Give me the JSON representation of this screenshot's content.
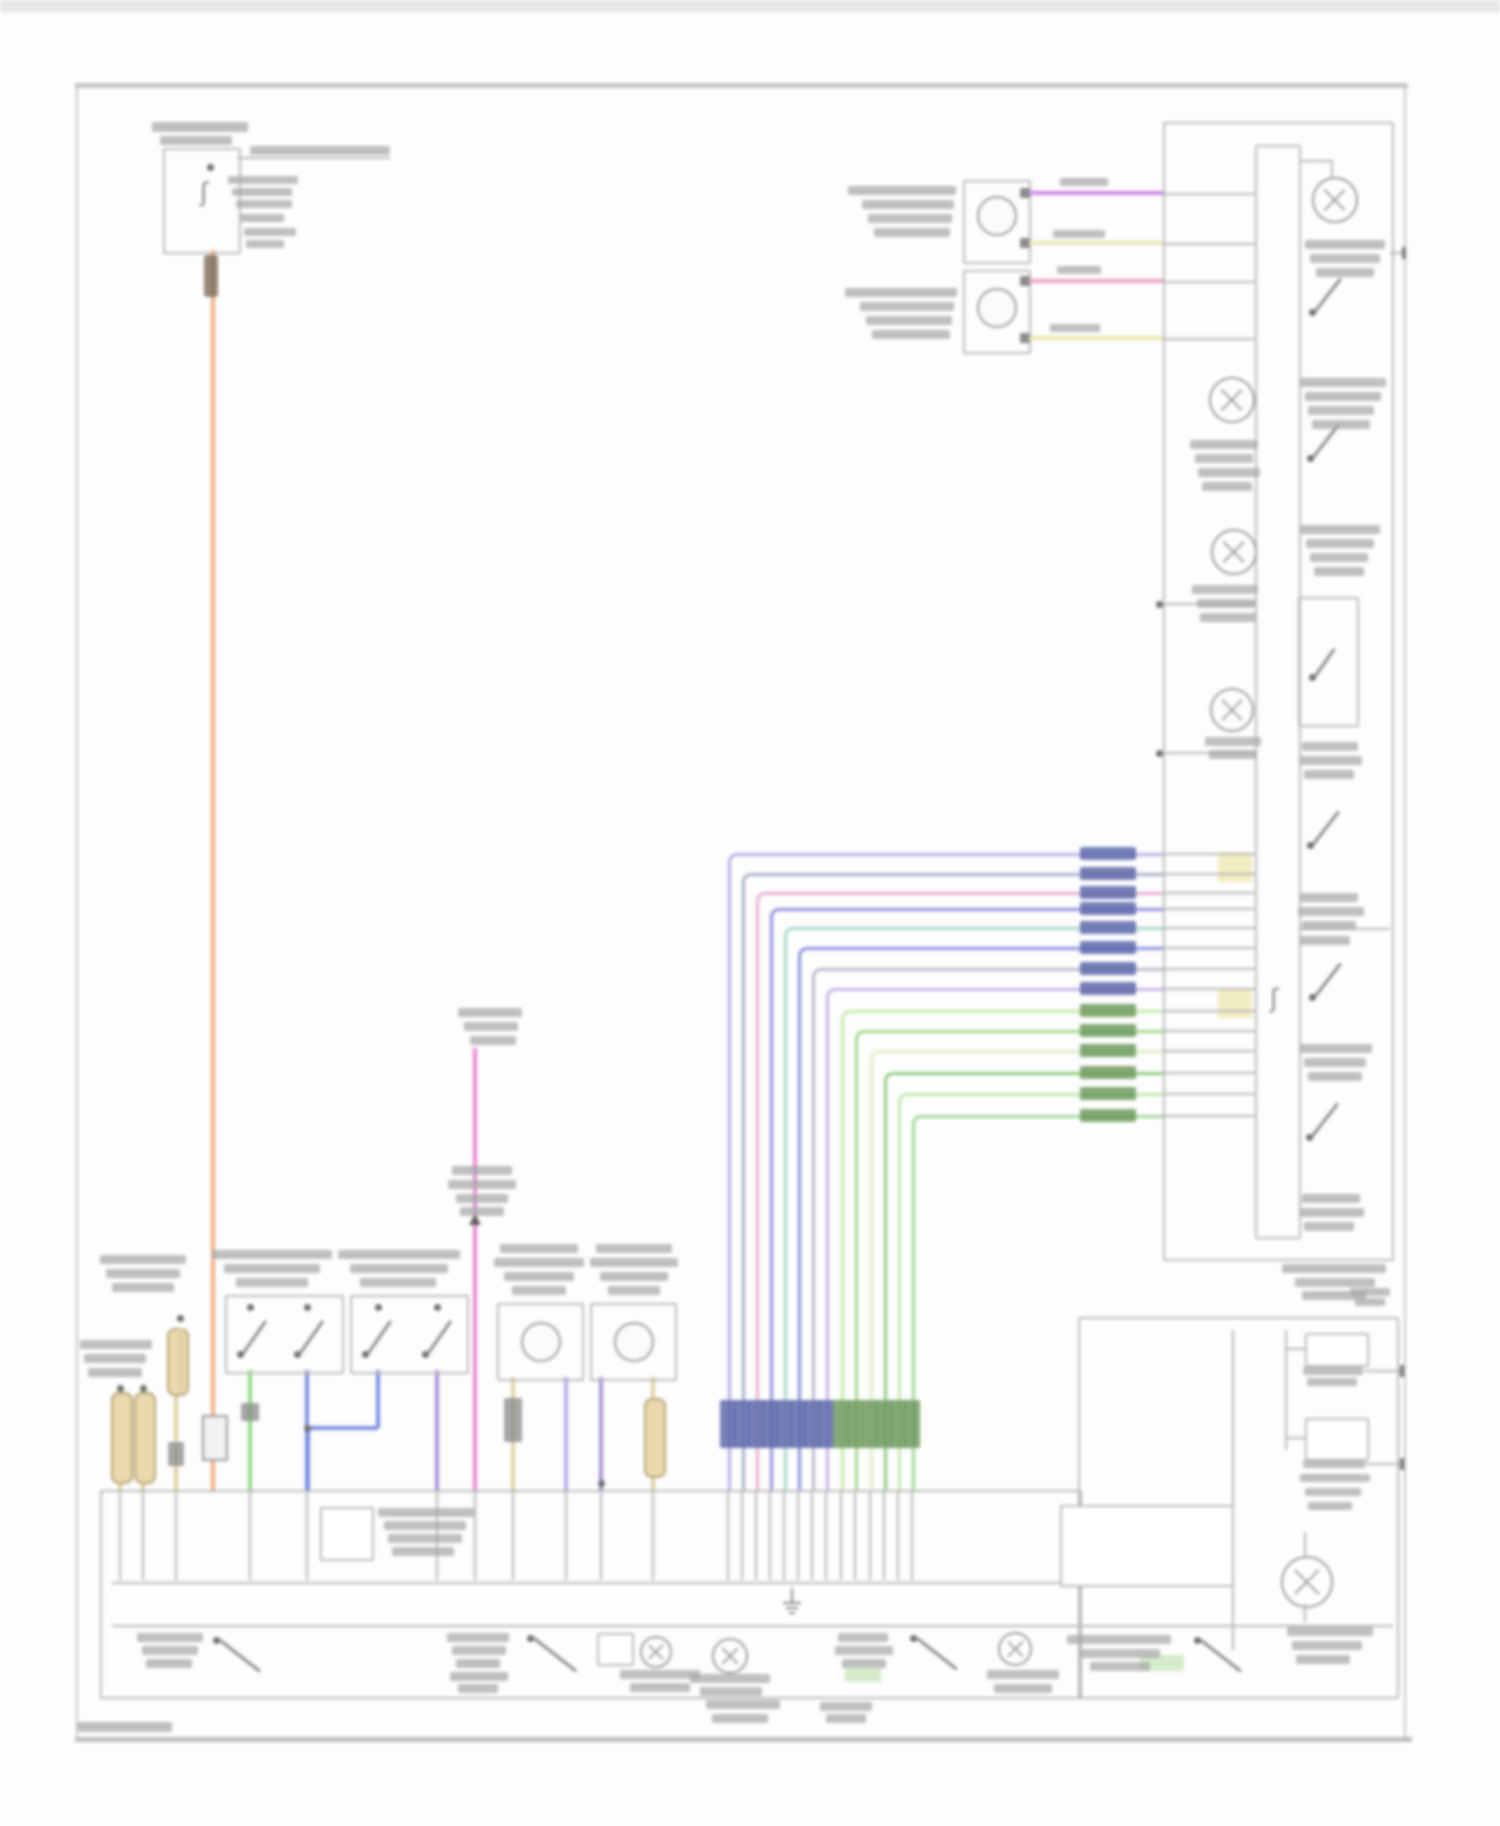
{
  "meta": {
    "kind": "automotive wiring diagram (blurred scan, all labels illegible)",
    "page_width": 1500,
    "page_height": 1826
  },
  "palette": {
    "line_gray": "#b6b6b6",
    "dark_mark": "#6e6e6e",
    "smudge_text": "#a6a6a6",
    "orange": "#f0ae85",
    "purple": "#cc88e8",
    "pale_yellow": "#ece5ad",
    "pink": "#f0a2c4",
    "magenta": "#ee86d6",
    "green": "#8edc84",
    "blue": "#7a8ce0",
    "lavender": "#b3aae6",
    "violet": "#a98fd8",
    "khaki": "#ddd0a0",
    "label_blue_block": "#5e68aa",
    "label_green_block": "#6f9a5f",
    "pale_yellow_block": "#efeab8",
    "pale_green_block": "#cfe8c2"
  },
  "frame": {
    "top_strip": [
      0,
      0,
      1500,
      12
    ],
    "top_border": [
      75,
      83,
      1333,
      5
    ],
    "left_border_x": 76,
    "right_border_x": 1404,
    "bottom_border": [
      75,
      1737,
      1337,
      5
    ],
    "border_top_y": 83,
    "border_bottom_y": 1742
  },
  "fuse_circuit": {
    "box": [
      163,
      148,
      74,
      102
    ],
    "stub_line_y": 157,
    "stub_x2": 390,
    "fuse_dot": [
      210,
      167
    ],
    "orange_riser": {
      "x": 211,
      "y1": 250,
      "y2": 1490
    },
    "connector_block": [
      202,
      1415,
      22,
      42
    ]
  },
  "top_motors": {
    "boxes": [
      [
        963,
        180,
        64,
        80
      ],
      [
        963,
        270,
        64,
        80
      ]
    ],
    "circles": [
      [
        977,
        196,
        36
      ],
      [
        977,
        288,
        36
      ]
    ],
    "pin_blocks": [
      [
        1020,
        188
      ],
      [
        1020,
        238
      ],
      [
        1020,
        276
      ],
      [
        1020,
        333
      ]
    ],
    "wires": [
      {
        "y": 193,
        "x1": 1029,
        "x2": 1163,
        "color": "purple"
      },
      {
        "y": 243,
        "x1": 1029,
        "x2": 1163,
        "color": "pale_yellow"
      },
      {
        "y": 281,
        "x1": 1029,
        "x2": 1163,
        "color": "pink"
      },
      {
        "y": 338,
        "x1": 1029,
        "x2": 1163,
        "color": "pale_yellow"
      }
    ]
  },
  "right_box": {
    "outer": [
      1163,
      122,
      227,
      1135
    ],
    "inner": [
      1255,
      145,
      42,
      1090
    ],
    "top_gray_lines_y": [
      193,
      243,
      281,
      338
    ],
    "tap_lines": [
      {
        "y": 603,
        "dot": true
      },
      {
        "y": 752,
        "dot": true
      }
    ],
    "tr_lamp": {
      "cx": 1333,
      "cy": 198,
      "r": 21,
      "elbow_h": [
        1299,
        160,
        34
      ],
      "elbow_v": [
        1331,
        160,
        20
      ]
    },
    "left_lamps": [
      [
        1230,
        398,
        21
      ],
      [
        1232,
        550,
        21
      ],
      [
        1230,
        708,
        20
      ]
    ],
    "switches": [
      {
        "x": 1312,
        "y": 312,
        "len": 42,
        "angle": -52
      },
      {
        "x": 1310,
        "y": 458,
        "len": 42,
        "angle": -52
      },
      {
        "x": 1310,
        "y": 845,
        "len": 42,
        "angle": -52
      },
      {
        "x": 1312,
        "y": 997,
        "len": 42,
        "angle": -52
      },
      {
        "x": 1309,
        "y": 1137,
        "len": 42,
        "angle": -52
      }
    ],
    "switch_box": [
      1298,
      597,
      57,
      126
    ],
    "inner_line": [
      1300,
      928,
      90
    ],
    "right_stub": {
      "y": 252,
      "x1": 1390,
      "x2": 1404
    },
    "squiggle": [
      1270,
      986
    ],
    "pale_blocks": [
      [
        1218,
        852,
        34,
        30
      ],
      [
        1218,
        990,
        34,
        28
      ]
    ]
  },
  "bundle": {
    "x_end": 1163,
    "bus_y": 1490,
    "label_x": 1080,
    "label_w": 56,
    "bottom_label_y": 1400,
    "bottom_label_h": 48,
    "wires": [
      {
        "y": 853,
        "cx": 728,
        "color": "#b7aee8",
        "group": "blue"
      },
      {
        "y": 873,
        "cx": 742,
        "color": "#a8b0c8",
        "group": "blue"
      },
      {
        "y": 892,
        "cx": 756,
        "color": "#e8b0d0",
        "group": "blue"
      },
      {
        "y": 908,
        "cx": 770,
        "color": "#9090dc",
        "group": "blue"
      },
      {
        "y": 927,
        "cx": 784,
        "color": "#a8d8cc",
        "group": "blue"
      },
      {
        "y": 947,
        "cx": 798,
        "color": "#8890e0",
        "group": "blue"
      },
      {
        "y": 968,
        "cx": 812,
        "color": "#b8b8cc",
        "group": "blue"
      },
      {
        "y": 988,
        "cx": 826,
        "color": "#c8b4e4",
        "group": "blue"
      },
      {
        "y": 1010,
        "cx": 841,
        "color": "#c8e8a8",
        "group": "green"
      },
      {
        "y": 1030,
        "cx": 855,
        "color": "#a8d890",
        "group": "green"
      },
      {
        "y": 1050,
        "cx": 870,
        "color": "#e0eec8",
        "group": "green"
      },
      {
        "y": 1072,
        "cx": 884,
        "color": "#90cc80",
        "group": "green"
      },
      {
        "y": 1093,
        "cx": 898,
        "color": "#c4e8b0",
        "group": "green"
      },
      {
        "y": 1115,
        "cx": 912,
        "color": "#a0d898",
        "group": "green"
      }
    ]
  },
  "bottom_area": {
    "module_box": [
      100,
      1490,
      978,
      205
    ],
    "right_box": [
      1078,
      1317,
      317,
      378
    ],
    "inner_line_1": [
      112,
      1582,
      948
    ],
    "inner_line_2": [
      112,
      1625,
      1281
    ],
    "inner_small_box": [
      320,
      1507,
      50,
      50
    ],
    "sub_box_right": [
      1060,
      1505,
      170,
      78
    ],
    "ground_symbol": [
      783,
      1588
    ],
    "bus_y": 1490,
    "gray_stub_y2": 1580
  },
  "bottom_drops": [
    {
      "x": 120,
      "color": "khaki",
      "y1": 1388,
      "capsule": [
        111,
        1392,
        88
      ],
      "dot": [
        120,
        1388
      ]
    },
    {
      "x": 143,
      "color": "khaki",
      "y1": 1388,
      "capsule": [
        134,
        1392,
        88
      ],
      "dot": [
        143,
        1388
      ]
    },
    {
      "x": 176,
      "color": "khaki",
      "y1": 1392,
      "dot": [
        176,
        1392
      ],
      "block": [
        168,
        1442,
        16,
        24
      ]
    },
    {
      "x": 250,
      "color": "green",
      "y1": 1370,
      "block": [
        241,
        1403,
        18,
        18
      ]
    },
    {
      "x": 307,
      "color": "blue",
      "y1": 1370
    },
    {
      "x": 437,
      "color": "violet",
      "y1": 1370
    },
    {
      "x": 475,
      "color": "magenta",
      "y1": 1048
    },
    {
      "x": 513,
      "color": "khaki",
      "y1": 1377,
      "block": [
        504,
        1398,
        18,
        44
      ]
    },
    {
      "x": 566,
      "color": "lavender",
      "y1": 1377
    },
    {
      "x": 601,
      "color": "violet",
      "y1": 1377,
      "dot": [
        601,
        1483
      ]
    },
    {
      "x": 653,
      "color": "khaki",
      "y1": 1377,
      "capsule": [
        644,
        1398,
        76
      ]
    }
  ],
  "blue_link": {
    "jx": 307,
    "jy": 1428,
    "x2": 378,
    "up_y": 1370
  },
  "left_components": {
    "switch_boxes": [
      [
        225,
        1295,
        115,
        75
      ],
      [
        350,
        1295,
        115,
        75
      ]
    ],
    "switch_pins": [
      [
        250,
        1307
      ],
      [
        307,
        1307
      ],
      [
        378,
        1307
      ],
      [
        437,
        1307
      ]
    ],
    "box_switches": [
      {
        "x": 240,
        "y": 1354,
        "len": 40,
        "angle": -55
      },
      {
        "x": 297,
        "y": 1354,
        "len": 40,
        "angle": -55
      },
      {
        "x": 365,
        "y": 1354,
        "len": 40,
        "angle": -55
      },
      {
        "x": 425,
        "y": 1354,
        "len": 40,
        "angle": -55
      }
    ],
    "motor_boxes": [
      [
        497,
        1303,
        83,
        74
      ],
      [
        590,
        1303,
        83,
        74
      ]
    ],
    "motor_circles": [
      [
        521,
        1322,
        36
      ],
      [
        614,
        1322,
        36
      ]
    ],
    "upper_capsule": [
      167,
      1328,
      64
    ],
    "upper_dot": [
      180,
      1318
    ],
    "pink_arrow": [
      469,
      1214
    ]
  },
  "bottom_row": {
    "switches": [
      {
        "x": 216,
        "y": 1640,
        "len": 52,
        "angle": 38
      },
      {
        "x": 530,
        "y": 1638,
        "len": 55,
        "angle": 38
      },
      {
        "x": 913,
        "y": 1638,
        "len": 52,
        "angle": 38
      },
      {
        "x": 1197,
        "y": 1640,
        "len": 52,
        "angle": 38
      }
    ],
    "small_box": [
      597,
      1633,
      33,
      29
    ],
    "lamps": [
      [
        640,
        1636,
        28
      ],
      [
        712,
        1638,
        32
      ],
      [
        998,
        1632,
        30
      ]
    ],
    "big_lamp": [
      1281,
      1556,
      48
    ],
    "big_lamp_line": [
      [
        1304,
        1532,
        26
      ],
      [
        1604,
        0,
        0
      ]
    ],
    "green_blocks": [
      [
        845,
        1668,
        36,
        14
      ],
      [
        1140,
        1655,
        44,
        16
      ]
    ]
  },
  "right_bottom_parts": {
    "inner_v1": [
      1232,
      1330,
      320
    ],
    "inner_v2": [
      1285,
      1330,
      120
    ],
    "boxA": [
      1305,
      1333,
      60,
      30
    ],
    "boxB": [
      1305,
      1418,
      60,
      39
    ],
    "stubA": {
      "y": 1370,
      "x1": 1365,
      "x2": 1402
    },
    "stubB": {
      "y": 1463,
      "x1": 1365,
      "x2": 1402
    },
    "linkA_y": 1348,
    "linkB_y": 1437
  },
  "unreadable_labels": [
    [
      152,
      122,
      96,
      10
    ],
    [
      160,
      136,
      72,
      9
    ],
    [
      250,
      146,
      140,
      9
    ],
    [
      228,
      176,
      70,
      8
    ],
    [
      232,
      188,
      60,
      8
    ],
    [
      236,
      200,
      56,
      8
    ],
    [
      240,
      214,
      44,
      8
    ],
    [
      244,
      228,
      52,
      8
    ],
    [
      246,
      240,
      38,
      8
    ],
    [
      848,
      186,
      108,
      9
    ],
    [
      862,
      200,
      92,
      9
    ],
    [
      868,
      214,
      84,
      9
    ],
    [
      874,
      228,
      76,
      9
    ],
    [
      845,
      288,
      112,
      9
    ],
    [
      860,
      302,
      94,
      9
    ],
    [
      866,
      316,
      86,
      9
    ],
    [
      872,
      330,
      78,
      9
    ],
    [
      1060,
      178,
      48,
      8
    ],
    [
      1053,
      230,
      52,
      8
    ],
    [
      1057,
      266,
      44,
      8
    ],
    [
      1050,
      324,
      50,
      8
    ],
    [
      1305,
      240,
      80,
      9
    ],
    [
      1310,
      254,
      70,
      9
    ],
    [
      1316,
      268,
      58,
      9
    ],
    [
      1300,
      378,
      86,
      9
    ],
    [
      1305,
      392,
      76,
      9
    ],
    [
      1308,
      406,
      66,
      9
    ],
    [
      1312,
      420,
      58,
      9
    ],
    [
      1190,
      440,
      68,
      9
    ],
    [
      1195,
      454,
      58,
      9
    ],
    [
      1198,
      468,
      62,
      9
    ],
    [
      1202,
      482,
      50,
      9
    ],
    [
      1300,
      525,
      80,
      9
    ],
    [
      1306,
      539,
      68,
      9
    ],
    [
      1310,
      553,
      58,
      9
    ],
    [
      1314,
      567,
      50,
      9
    ],
    [
      1192,
      585,
      66,
      9
    ],
    [
      1197,
      599,
      58,
      9
    ],
    [
      1200,
      613,
      56,
      9
    ],
    [
      1205,
      737,
      56,
      9
    ],
    [
      1209,
      750,
      48,
      9
    ],
    [
      1302,
      742,
      56,
      9
    ],
    [
      1300,
      756,
      62,
      9
    ],
    [
      1304,
      770,
      50,
      9
    ],
    [
      1300,
      893,
      58,
      9
    ],
    [
      1298,
      907,
      66,
      9
    ],
    [
      1302,
      921,
      54,
      9
    ],
    [
      1300,
      936,
      50,
      9
    ],
    [
      1300,
      1044,
      72,
      9
    ],
    [
      1304,
      1058,
      62,
      9
    ],
    [
      1308,
      1072,
      54,
      9
    ],
    [
      1302,
      1194,
      58,
      9
    ],
    [
      1300,
      1208,
      64,
      9
    ],
    [
      1304,
      1222,
      50,
      9
    ],
    [
      1282,
      1264,
      104,
      9
    ],
    [
      1295,
      1278,
      80,
      9
    ],
    [
      1302,
      1291,
      64,
      9
    ],
    [
      100,
      1255,
      86,
      9
    ],
    [
      106,
      1269,
      74,
      9
    ],
    [
      112,
      1283,
      62,
      9
    ],
    [
      80,
      1340,
      72,
      9
    ],
    [
      84,
      1354,
      62,
      9
    ],
    [
      88,
      1368,
      54,
      9
    ],
    [
      212,
      1250,
      120,
      9
    ],
    [
      224,
      1264,
      96,
      9
    ],
    [
      236,
      1278,
      72,
      9
    ],
    [
      338,
      1250,
      122,
      9
    ],
    [
      350,
      1264,
      98,
      9
    ],
    [
      360,
      1278,
      76,
      9
    ],
    [
      458,
      1008,
      64,
      9
    ],
    [
      464,
      1022,
      54,
      9
    ],
    [
      470,
      1036,
      46,
      9
    ],
    [
      452,
      1166,
      60,
      9
    ],
    [
      448,
      1180,
      68,
      9
    ],
    [
      456,
      1194,
      52,
      9
    ],
    [
      460,
      1207,
      44,
      9
    ],
    [
      500,
      1244,
      78,
      9
    ],
    [
      494,
      1258,
      90,
      9
    ],
    [
      504,
      1272,
      70,
      9
    ],
    [
      512,
      1286,
      54,
      9
    ],
    [
      596,
      1244,
      76,
      9
    ],
    [
      590,
      1258,
      88,
      9
    ],
    [
      600,
      1272,
      68,
      9
    ],
    [
      608,
      1286,
      52,
      9
    ],
    [
      378,
      1508,
      96,
      9
    ],
    [
      384,
      1521,
      82,
      9
    ],
    [
      388,
      1534,
      74,
      9
    ],
    [
      392,
      1547,
      62,
      9
    ],
    [
      137,
      1633,
      66,
      9
    ],
    [
      142,
      1646,
      56,
      9
    ],
    [
      146,
      1659,
      46,
      9
    ],
    [
      447,
      1633,
      62,
      9
    ],
    [
      452,
      1646,
      54,
      9
    ],
    [
      456,
      1659,
      44,
      9
    ],
    [
      450,
      1672,
      58,
      9
    ],
    [
      458,
      1684,
      40,
      9
    ],
    [
      620,
      1670,
      80,
      9
    ],
    [
      630,
      1683,
      60,
      9
    ],
    [
      690,
      1674,
      80,
      9
    ],
    [
      700,
      1687,
      62,
      9
    ],
    [
      706,
      1700,
      74,
      9
    ],
    [
      712,
      1714,
      56,
      9
    ],
    [
      838,
      1633,
      50,
      9
    ],
    [
      835,
      1646,
      58,
      9
    ],
    [
      842,
      1659,
      44,
      9
    ],
    [
      987,
      1670,
      72,
      9
    ],
    [
      994,
      1684,
      58,
      9
    ],
    [
      820,
      1702,
      52,
      9
    ],
    [
      826,
      1714,
      40,
      9
    ],
    [
      1067,
      1635,
      104,
      9
    ],
    [
      1080,
      1649,
      80,
      9
    ],
    [
      1090,
      1662,
      60,
      9
    ],
    [
      1303,
      1367,
      60,
      8
    ],
    [
      1307,
      1378,
      50,
      8
    ],
    [
      1303,
      1460,
      62,
      8
    ],
    [
      1300,
      1474,
      70,
      8
    ],
    [
      1305,
      1488,
      56,
      8
    ],
    [
      1308,
      1502,
      44,
      8
    ],
    [
      1350,
      1288,
      40,
      8
    ],
    [
      1355,
      1298,
      30,
      8
    ],
    [
      1287,
      1627,
      86,
      9
    ],
    [
      1292,
      1641,
      70,
      9
    ],
    [
      1296,
      1655,
      54,
      9
    ],
    [
      78,
      1722,
      94,
      10
    ]
  ]
}
